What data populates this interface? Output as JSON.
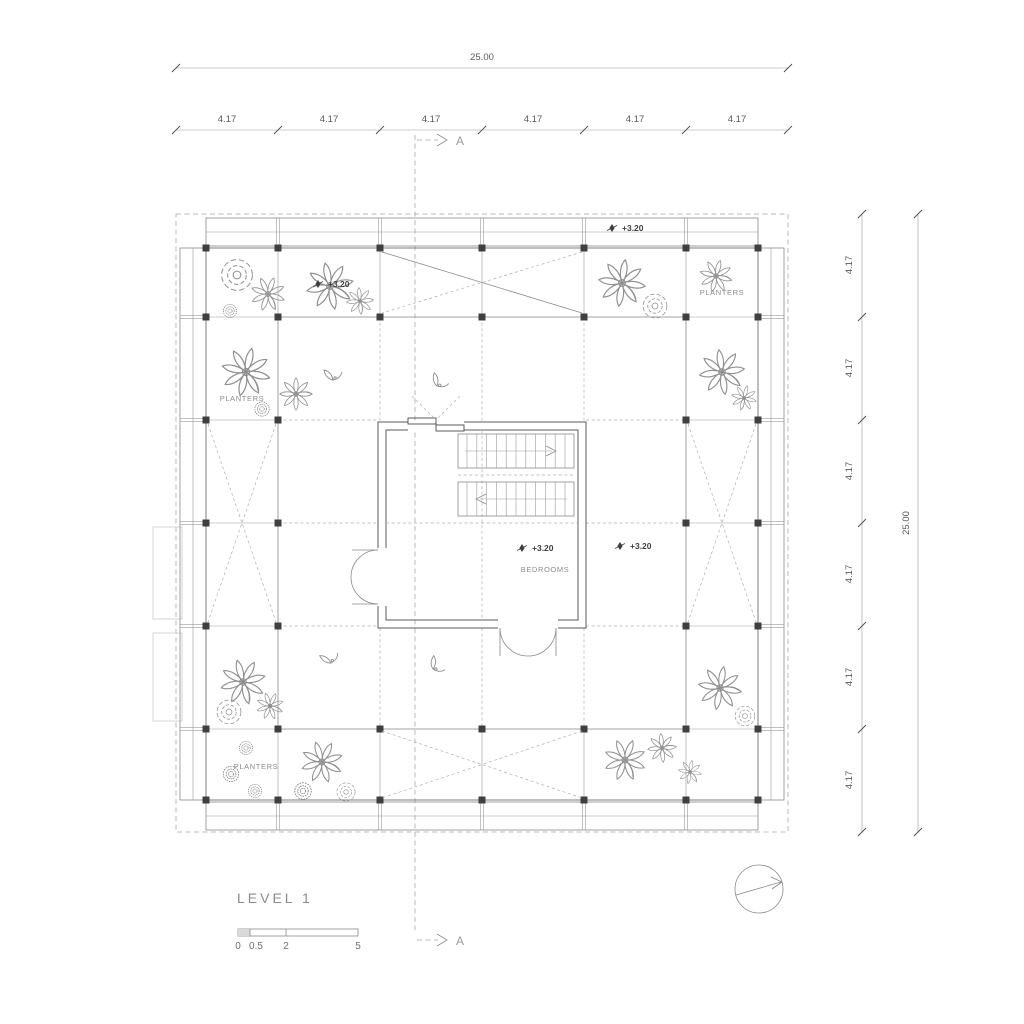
{
  "drawing": {
    "title": "LEVEL 1",
    "room_label": "BEDROOMS",
    "section_marker": "A",
    "planter_labels": [
      "PLANTERS",
      "PLANTERS",
      "PLANTERS"
    ],
    "level_markers": [
      "+3.20",
      "+3.20",
      "+3.20",
      "+3.20"
    ],
    "dimensions": {
      "top_overall": "25.00",
      "top_bays": [
        "4.17",
        "4.17",
        "4.17",
        "4.17",
        "4.17",
        "4.17"
      ],
      "right_overall": "25.00",
      "right_bays": [
        "4.17",
        "4.17",
        "4.17",
        "4.17",
        "4.17",
        "4.17"
      ]
    },
    "scale_bar": {
      "labels": [
        "0",
        "0.5",
        "2",
        "5"
      ]
    },
    "colors": {
      "background": "#ffffff",
      "linework": "#8a8a8a",
      "dark_linework": "#3f3f3f",
      "annotation_text": "#5a5a5a"
    }
  }
}
